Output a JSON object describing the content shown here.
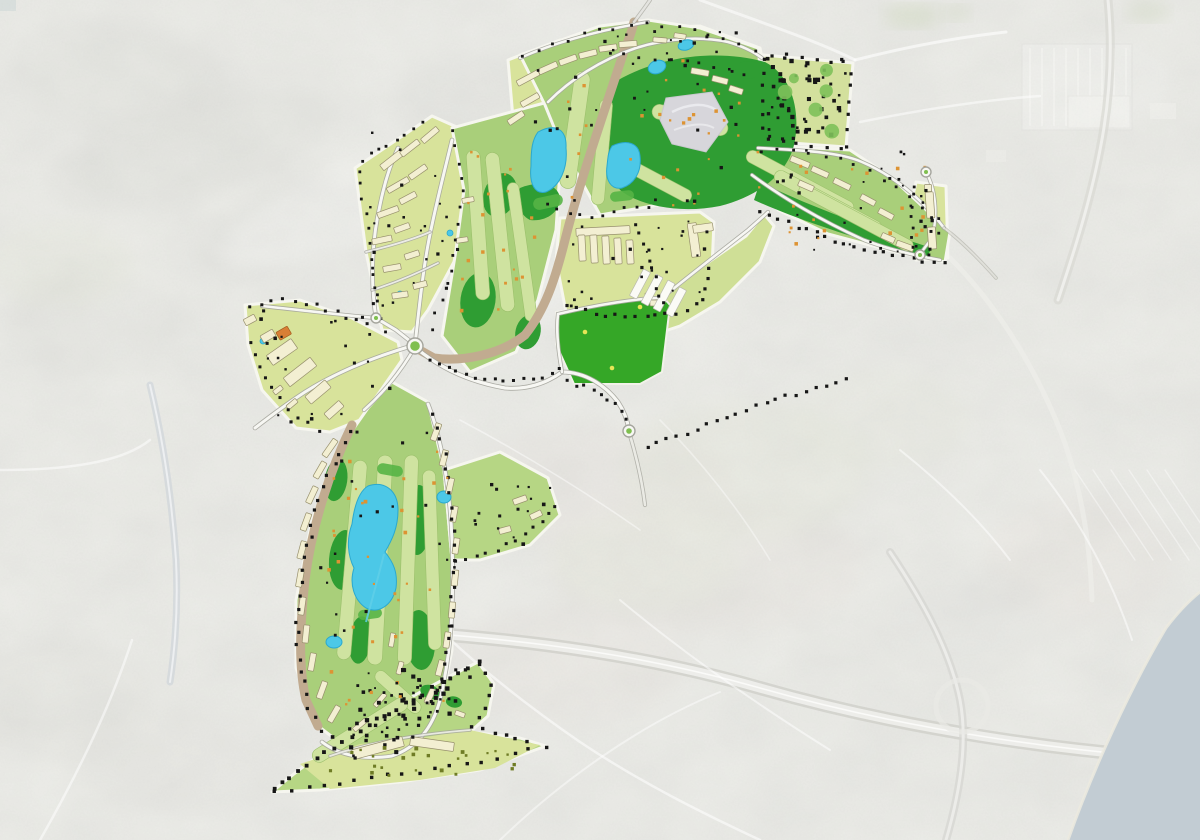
{
  "page": {
    "title": "Golf resort master plan overlaid on faded aerial photograph",
    "visible_text": "none"
  },
  "map": {
    "type": "masterplan-overlay-aerial",
    "orientation": "coastline at bottom-right corner",
    "features": {
      "roundabouts": 5,
      "upper_lakes": 2,
      "upper_ponds": 2,
      "valley_lake": 1,
      "valley_ponds": 2,
      "residential_pools": 3,
      "quarry_patch": 1,
      "sports_field": 1,
      "tree_park": 1,
      "highway": "curves along south edge of plan",
      "sea": "bottom-right"
    },
    "palette": {
      "satellite_base": "#dcddd8",
      "satellite_shadow": "#c6c8c2",
      "satellite_light": "#ebecea",
      "urban_tint": "#d8cfc9",
      "field_tint": "#d5dac7",
      "sea": "#c2ccd3",
      "coast_sand": "#eceadf",
      "sat_road": "#ffffff",
      "highway": "#d6d6d1",
      "highway_core": "#efefec",
      "parcel_green": "#d8e39b",
      "golf_base": "#a9cf7a",
      "golf_base2": "#b6d684",
      "fairway": "#cfe3a0",
      "fairway_edge": "#9cc06c",
      "dark_green": "#2f9d33",
      "bright_field": "#35a727",
      "accent_green": "#57b445",
      "park_green": "#7ec15a",
      "lake": "#4cc8e7",
      "lake_edge": "#2aa8cf",
      "building": "#f3efd2",
      "building_edge": "#97906d",
      "white_building": "#fbfbf6",
      "orange_building": "#d87f35",
      "tan_road": "#c1ab90",
      "road_core": "#f7f7f3",
      "road_casing": "#a5a59d",
      "tree_dark": "#161616",
      "tree_orange": "#dd9333",
      "tree_olive": "#6f7c25",
      "roundabout_green": "#7fbf4f",
      "quarry": "#d7d6db",
      "yellow_speck": "#e6e557",
      "teal_corner": "#9db6ba"
    }
  }
}
